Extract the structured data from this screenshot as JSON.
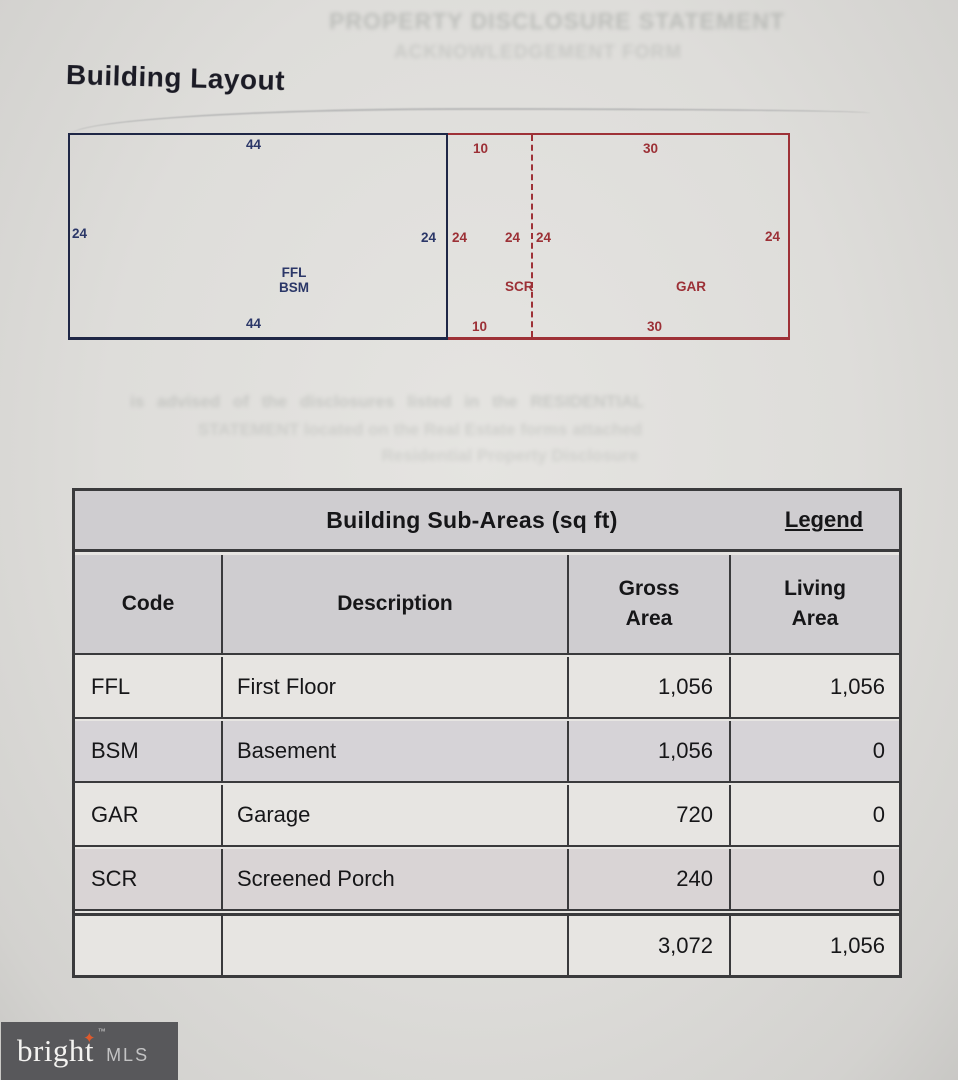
{
  "page": {
    "title": "Building Layout"
  },
  "ghost": {
    "top_line1": "PROPERTY DISCLOSURE STATEMENT",
    "top_line2": "ACKNOWLEDGEMENT FORM",
    "mid_line1": "is advised of the disclosures listed in the RESIDENTIAL",
    "mid_line2": "STATEMENT located on the Real Estate forms attached",
    "mid_line3": "Residential Property Disclosure"
  },
  "diagram": {
    "colors": {
      "main_outline": "#1f2746",
      "main_text": "#2b3768",
      "annex_outline": "#9e3137",
      "annex_text": "#9c3036"
    },
    "main": {
      "label_line1": "FFL",
      "label_line2": "BSM",
      "top_dim": "44",
      "bottom_dim": "44",
      "left_dim": "24",
      "right_dim": "24"
    },
    "scr": {
      "label": "SCR",
      "top_dim": "10",
      "bottom_dim": "10",
      "left_dim": "24",
      "right_dim": "24"
    },
    "gar": {
      "label": "GAR",
      "top_dim": "30",
      "bottom_dim": "30",
      "right_dim": "24"
    }
  },
  "table": {
    "title": "Building Sub-Areas (sq ft)",
    "legend_label": "Legend",
    "headers": {
      "code": "Code",
      "description": "Description",
      "gross_line1": "Gross",
      "gross_line2": "Area",
      "living_line1": "Living",
      "living_line2": "Area"
    },
    "rows": [
      {
        "code": "FFL",
        "description": "First Floor",
        "gross": "1,056",
        "living": "1,056"
      },
      {
        "code": "BSM",
        "description": "Basement",
        "gross": "1,056",
        "living": "0"
      },
      {
        "code": "GAR",
        "description": "Garage",
        "gross": "720",
        "living": "0"
      },
      {
        "code": "SCR",
        "description": "Screened Porch",
        "gross": "240",
        "living": "0"
      }
    ],
    "totals": {
      "gross": "3,072",
      "living": "1,056"
    }
  },
  "logo": {
    "brand": "bright",
    "tm": "™",
    "suffix": "MLS",
    "spark_color": "#dd5a2d"
  }
}
